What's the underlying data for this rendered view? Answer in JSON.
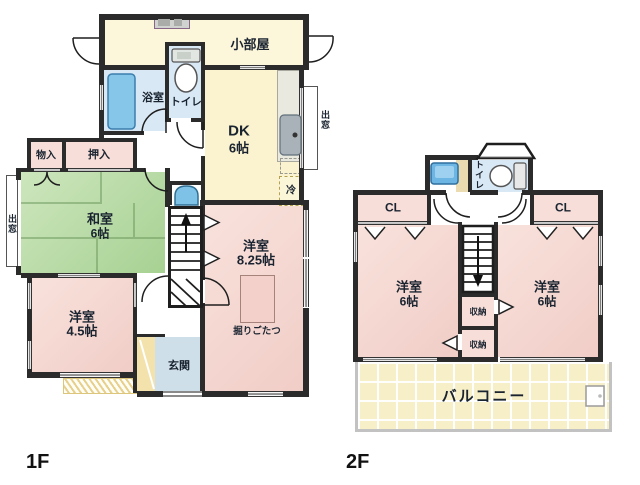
{
  "floors": {
    "f1": {
      "label": "1F"
    },
    "f2": {
      "label": "2F"
    }
  },
  "f1": {
    "kobeya": "小部屋",
    "bath": "浴室",
    "toilet": "トイレ",
    "dk": "DK",
    "dk_size": "6帖",
    "demado": "出窓",
    "rei": "冷",
    "mononyu": "物入",
    "oshiire": "押入",
    "washitsu": "和室",
    "washitsu_size": "6帖",
    "y825": "洋室",
    "y825_size": "8.25帖",
    "horigotatsu": "掘りごたつ",
    "y45": "洋室",
    "y45_size": "4.5帖",
    "genkan": "玄関"
  },
  "f2": {
    "toilet": "トイレ",
    "cl": "CL",
    "yoshitsu": "洋室",
    "yoshitsu_size": "6帖",
    "shuno": "収納",
    "balcony": "バルコニー"
  },
  "colors": {
    "wall": "#2b2b2b",
    "room_pink": "#f5d5cf",
    "tatami_green": "#b5d9a4",
    "cream_yellow": "#fbf3cf",
    "water_blue": "#d9e8f5",
    "entrance_blue": "#cfdfe9",
    "balcony_yellow": "#f6efc8"
  }
}
